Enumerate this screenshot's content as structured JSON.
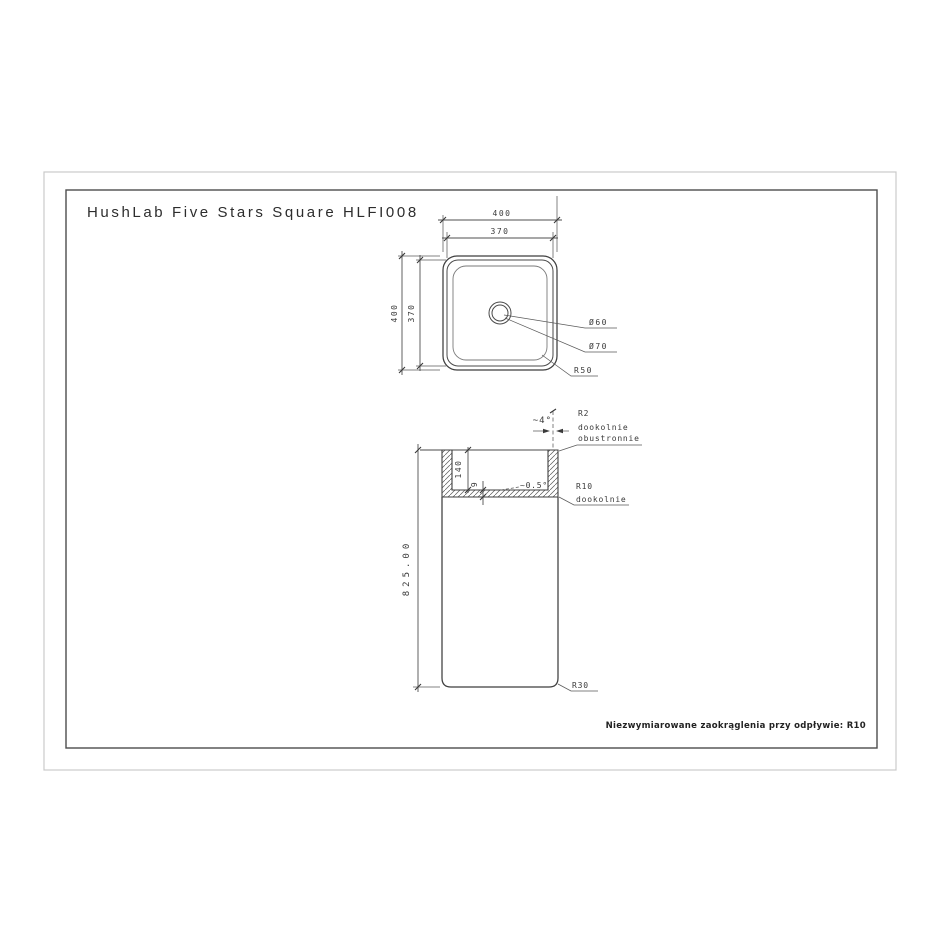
{
  "drawing": {
    "title": "HushLab Five Stars Square HLFI008",
    "note": "Niezwymiarowane zaokrąglenia przy odpływie: R10",
    "top_view": {
      "width_outer": "400",
      "width_inner": "370",
      "height_outer": "400",
      "height_inner": "370",
      "drain_hole_diameter": "Ø60",
      "drain_flange_diameter": "Ø70",
      "corner_radius": "R50"
    },
    "section_view": {
      "wall_draft_angle": "~4°",
      "rim_radius": "R2",
      "rim_radius_note_line1": "dookolnie",
      "rim_radius_note_line2": "obustronnie",
      "basin_depth": "140",
      "bottom_thickness": "9",
      "bottom_slope": "~0.5°",
      "bottom_radius": "R10",
      "bottom_radius_note": "dookolnie",
      "total_height": "825.00",
      "base_corner_radius": "R30"
    },
    "colors": {
      "line": "#3f3f3f",
      "outer_frame": "#cacaca",
      "inner_frame": "#4d4d4d"
    }
  }
}
